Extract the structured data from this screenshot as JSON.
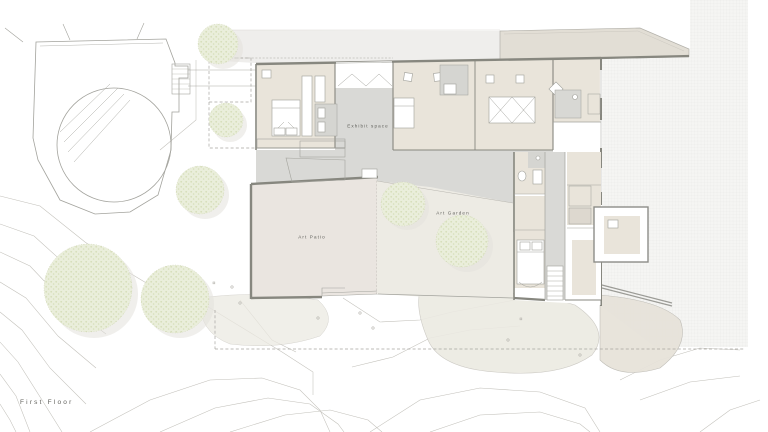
{
  "plan": {
    "floor_label": "First Floor",
    "room_labels": {
      "exhibit": "Exhibit space",
      "patio": "Art Patio",
      "garden": "Art Garden"
    }
  },
  "colors": {
    "paper": "#ffffff",
    "wall": "#87877f",
    "wall-light": "#a3a39d",
    "room-floor": "#e9e4da",
    "circulation": "#d9d9d6",
    "patio-floor": "#eae5e0",
    "garden": "#edebe4",
    "canopy": "#e2ded5",
    "road": "#efeeec",
    "grid-bg": "#f5f5f3",
    "grid-line": "#e8e8e5",
    "tree": "#eaeedb",
    "tree-dot": "#d6deba",
    "tree-shadow": "#e3e2dd",
    "contour": "#c2c0ba",
    "dash": "#a7a5a0",
    "furniture": "#a0a09a",
    "terrain-patch": "#eceae2",
    "label": "#5f5f5a"
  }
}
